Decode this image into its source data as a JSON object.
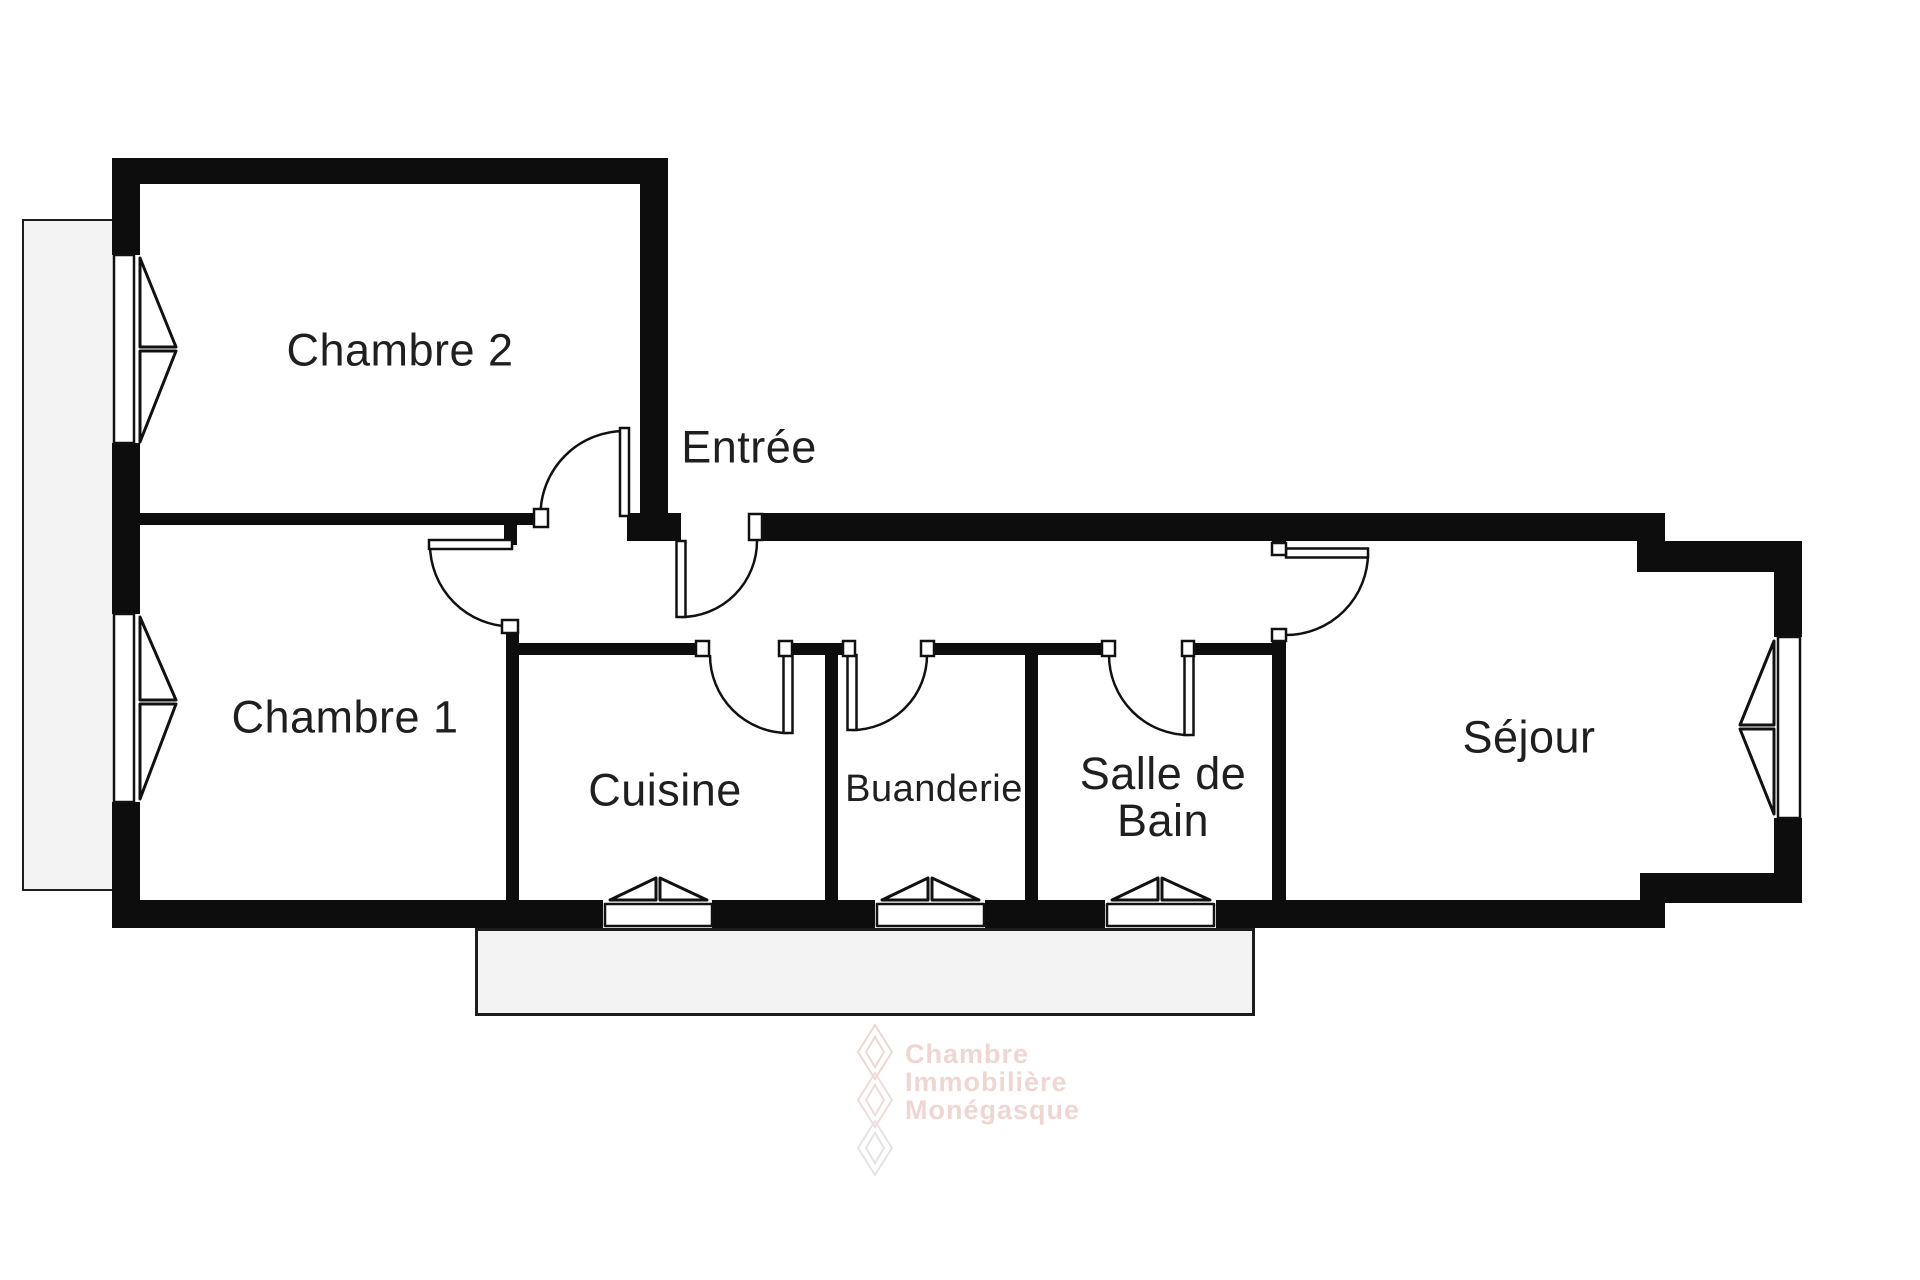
{
  "plan": {
    "type": "floor-plan",
    "rooms": [
      {
        "id": "chambre2",
        "label": "Chambre 2"
      },
      {
        "id": "chambre1",
        "label": "Chambre 1"
      },
      {
        "id": "entree",
        "label": "Entrée"
      },
      {
        "id": "cuisine",
        "label": "Cuisine"
      },
      {
        "id": "buanderie",
        "label": "Buanderie"
      },
      {
        "id": "salle-de-bain",
        "label": "Salle de Bain",
        "lines": [
          "Salle de",
          "Bain"
        ]
      },
      {
        "id": "sejour",
        "label": "Séjour"
      }
    ],
    "features": {
      "doors": [
        "chambre2",
        "chambre1",
        "entry",
        "cuisine",
        "buanderie",
        "salle-de-bain",
        "sejour"
      ],
      "windows": [
        "chambre2-left",
        "chambre1-left",
        "cuisine-bottom",
        "buanderie-bottom",
        "salle-de-bain-bottom",
        "sejour-right"
      ],
      "outdoor_areas": [
        "balcony-left",
        "terrace-bottom"
      ]
    }
  },
  "watermark": {
    "logo": "diamond-lattice-logo",
    "lines": [
      "Chambre",
      "Immobilière",
      "Monégasque"
    ]
  },
  "colors": {
    "background": "#ffffff",
    "wall": "#0d0d0d",
    "label_text": "#1f1f1f",
    "outdoor_fill": "#f3f3f3",
    "outdoor_border": "#1c1c1c",
    "watermark_pink": "#eed6d3",
    "watermark_gray": "#e4e4e4"
  }
}
